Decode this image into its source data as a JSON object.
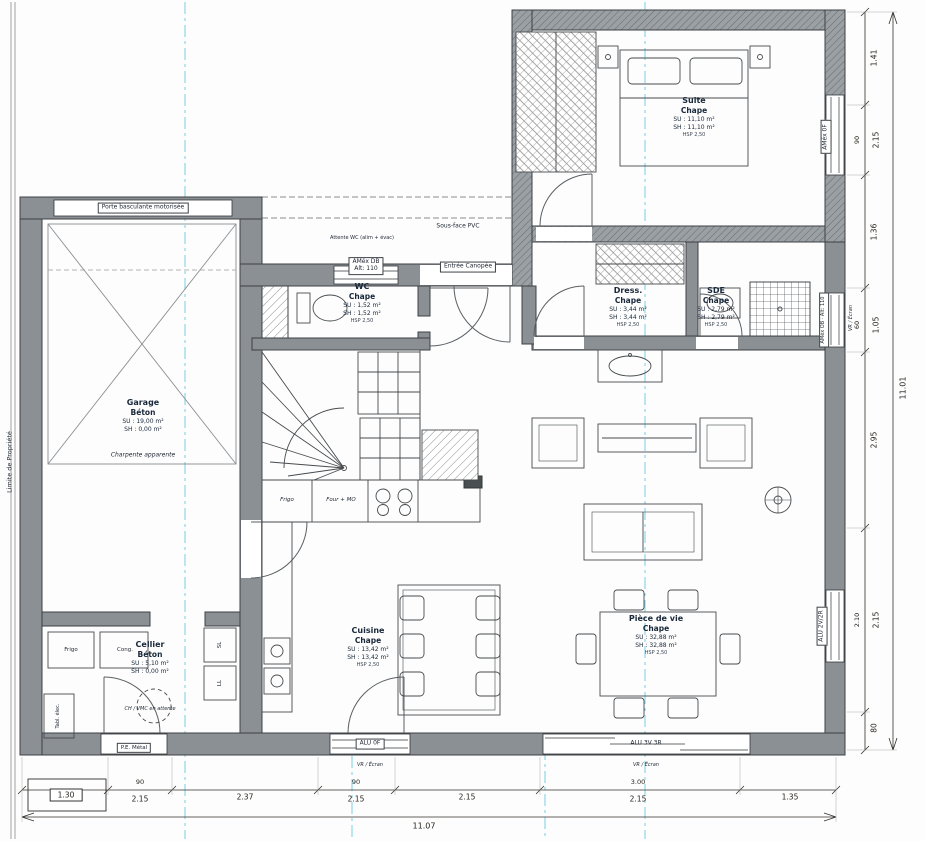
{
  "plan": {
    "property_line": "Limite de Propriété",
    "sous_face": "Sous-face PVC",
    "attente_note": "Attente WC (alim + évac)",
    "canopy": "Entrée Canopée"
  },
  "rooms": {
    "suite": {
      "name": "Suite",
      "floor": "Chape",
      "su": "SU : 11,10 m²",
      "sh": "SH : 11,10 m²",
      "hsp": "HSP 2,50"
    },
    "wc": {
      "name": "WC",
      "floor": "Chape",
      "su": "SU : 1,52 m²",
      "sh": "SH : 1,52 m²",
      "hsp": "HSP 2,50"
    },
    "dress": {
      "name": "Dress.",
      "floor": "Chape",
      "su": "SU : 3,44 m²",
      "sh": "SH : 3,44 m²",
      "hsp": "HSP 2,50"
    },
    "sde": {
      "name": "SDE",
      "floor": "Chape",
      "su": "SU : 2,79 m²",
      "sh": "SH : 2,79 m²",
      "hsp": "HSP 2,50"
    },
    "garage": {
      "name": "Garage",
      "floor": "Béton",
      "su": "SU : 19,00 m²",
      "sh": "SH : 0,00 m²",
      "note": "Charpente apparente"
    },
    "cellier": {
      "name": "Cellier",
      "floor": "Béton",
      "su": "SU : 5,10 m²",
      "sh": "SH : 0,00 m²",
      "note": "CH / VMC en attente"
    },
    "cuisine": {
      "name": "Cuisine",
      "floor": "Chape",
      "su": "SU : 13,42 m²",
      "sh": "SH : 13,42 m²",
      "hsp": "HSP 2,50"
    },
    "vie": {
      "name": "Pièce de vie",
      "floor": "Chape",
      "su": "SU : 32,88 m²",
      "sh": "SH : 32,88 m²",
      "hsp": "HSP 2,50"
    }
  },
  "openings": {
    "garage_door": "Porte basculante motorisée",
    "amex_db_line1": "AMéx DB",
    "amex_db_line2": "Alt: 110",
    "amex_0f": "AMéx 0F",
    "amex_ob": "AMéx OB · Alt: 110",
    "alu_2v2r": "ALU 2V/2R",
    "alu_0f": "ALU 0F",
    "alu_3v3r": "ALU 3V 3R",
    "vr_ecran": "VR / Écran",
    "pe_metal": "P.E. Métal"
  },
  "appliances": {
    "frigo": "Frigo",
    "cong": "Cong.",
    "sl": "SL",
    "ll": "LL",
    "four_mo": "Four + MO",
    "tableau": "Tabl. élec."
  },
  "dimensions": {
    "bottom": [
      {
        "v": "1.30"
      },
      {
        "w": "90",
        "v": "2.15"
      },
      {
        "v": "2.37"
      },
      {
        "w": "90",
        "v": "2.15"
      },
      {
        "v": "2.15"
      },
      {
        "w": "3.00",
        "v": "2.15"
      },
      {
        "v": "1.35"
      }
    ],
    "bottom_total": "11.07",
    "right": [
      {
        "v": "1.41"
      },
      {
        "w": "90",
        "v": "2.15"
      },
      {
        "v": "1.36"
      },
      {
        "w": "60",
        "v": "1.05"
      },
      {
        "v": "2.95"
      },
      {
        "w": "2.10",
        "v": "2.15"
      },
      {
        "v": "80"
      }
    ],
    "right_total": "11.01"
  }
}
